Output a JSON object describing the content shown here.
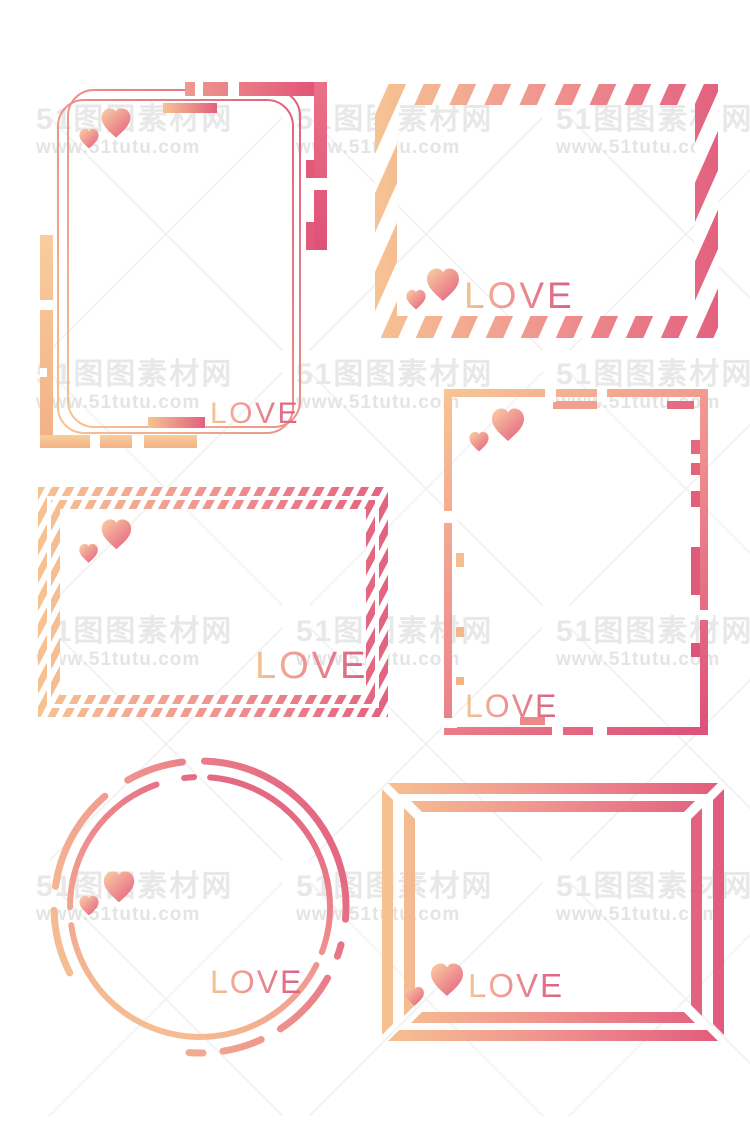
{
  "canvas": {
    "width": 750,
    "height": 1129,
    "background": "#ffffff"
  },
  "colors": {
    "peach": "#F6C390",
    "pink": "#E2607F",
    "deep_pink": "#DE537B",
    "heart_light": "#F9CDA2",
    "heart_dark": "#E4607E",
    "love_gradient_start": "#F2C692",
    "love_gradient_end": "#D85E80",
    "watermark_gray": "#E8E8E8"
  },
  "watermark": {
    "title": "51图图素材网",
    "url": "www.51tutu.com",
    "cols": [
      36,
      296,
      556
    ],
    "rows": [
      104,
      359,
      616,
      871
    ],
    "cross_cols": [
      166,
      426,
      686
    ],
    "cross_rows": [
      233,
      488,
      743,
      998
    ]
  },
  "frames": [
    {
      "name": "rounded-card-frame",
      "label": "LOVE"
    },
    {
      "name": "striped-envelope-frame",
      "label": "LOVE"
    },
    {
      "name": "hatched-border-frame",
      "label": "LOVE"
    },
    {
      "name": "notched-tech-frame",
      "label": "LOVE"
    },
    {
      "name": "dashed-circle-frame",
      "label": "LOVE"
    },
    {
      "name": "beveled-double-frame",
      "label": "LOVE"
    }
  ]
}
